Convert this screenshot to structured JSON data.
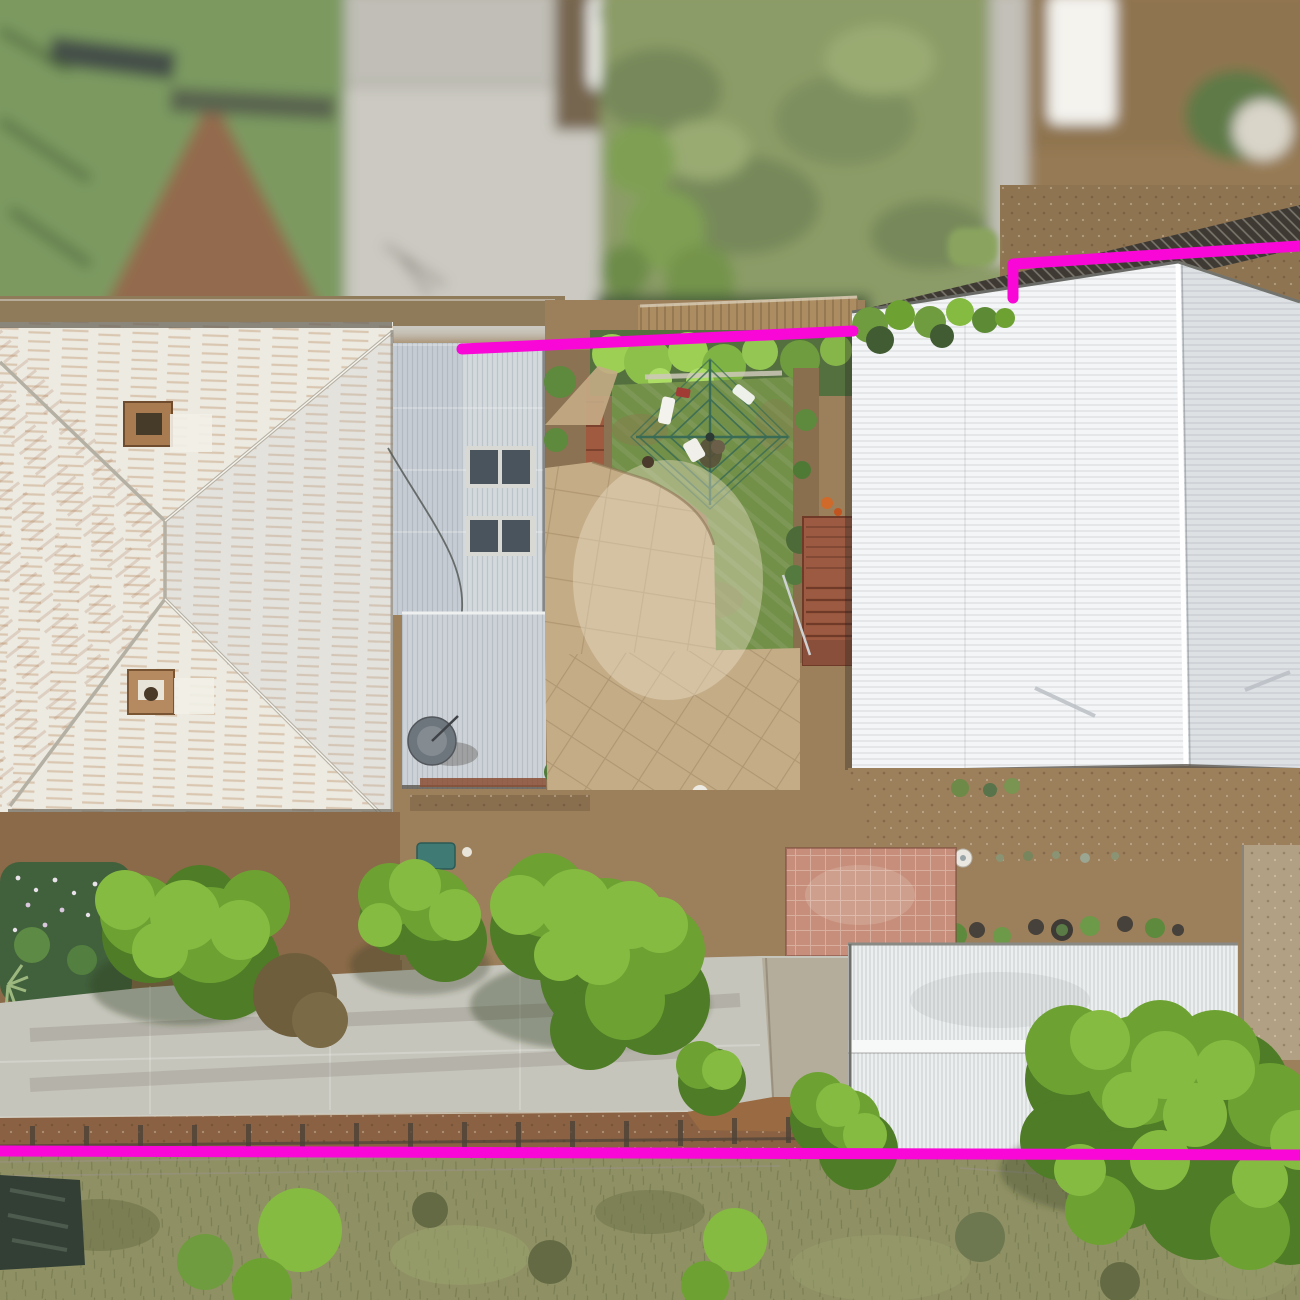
{
  "image": {
    "kind": "aerial-drone-photograph",
    "subject": "residential property seen from directly above with a magenta land-boundary outline overlay",
    "width": 1300,
    "height": 1300,
    "visible_text": []
  },
  "boundary_overlay": {
    "color": "#f907d6",
    "stroke_width": 11,
    "linecap": "round",
    "segments": [
      {
        "id": "rear-boundary-west",
        "points": [
          [
            462,
            349
          ],
          [
            853,
            331
          ]
        ]
      },
      {
        "id": "rear-boundary-east",
        "points": [
          [
            1013,
            298
          ],
          [
            1013,
            264
          ],
          [
            1300,
            246
          ]
        ]
      },
      {
        "id": "front-boundary-street-side",
        "points": [
          [
            0,
            1151
          ],
          [
            1300,
            1155
          ]
        ]
      }
    ]
  },
  "palette": {
    "house_roof": "#edeae1",
    "extension_roof": "#c5ccd3",
    "wing_roof": "#ccd2d7",
    "shed_left": "#f3f5f6",
    "shed_right": "#dde1e4",
    "garage": "#eceff0",
    "lawn": "#739049",
    "paving": "#c4ac86",
    "driveway": "#c6c5bc",
    "pink_tiles": "#c78f7b",
    "dirt": "#9c7f5b",
    "dirt_rust": "#8a6243",
    "grass_bottom": "#8f9164",
    "tree_bright": "#86bb42",
    "tree_mid": "#6da233",
    "tree_dark": "#4f7c26",
    "blur_green_roof": "#7c9a60",
    "blur_gray_roof": "#cbc9c1",
    "blur_grass": "#8c9c68",
    "rust": "#a9713f"
  },
  "scene_elements": [
    {
      "id": "blurred-neighbor-strip",
      "label": "out-of-focus neighbouring roofs, van and grass along top edge"
    },
    {
      "id": "main-house-roof",
      "label": "white corrugated hip roof with two rusty chimneys"
    },
    {
      "id": "extension-roof",
      "label": "blue-grey skillion roof with two solar-panel pairs"
    },
    {
      "id": "rear-wing-roof",
      "label": "grey corrugated rear wing roof with satellite dish"
    },
    {
      "id": "backyard-lawn",
      "label": "green lawn with rotary clothesline and washing"
    },
    {
      "id": "concrete-paving",
      "label": "tan crazy-paved courtyard"
    },
    {
      "id": "timber-deck-stairs",
      "label": "red-brown deck and steps beside shed"
    },
    {
      "id": "large-shed-roof",
      "label": "large white gable shed roof on right"
    },
    {
      "id": "pot-plant-row",
      "label": "row of potted plants and bird bath"
    },
    {
      "id": "pink-tiled-patio",
      "label": "pink tiled patio"
    },
    {
      "id": "driveway",
      "label": "long concrete driveway"
    },
    {
      "id": "garage-roof",
      "label": "white corrugated garage roof bottom right"
    },
    {
      "id": "trees-canopy",
      "label": "bright green tree canopies"
    },
    {
      "id": "street-grass",
      "label": "olive grass verge along bottom"
    }
  ]
}
